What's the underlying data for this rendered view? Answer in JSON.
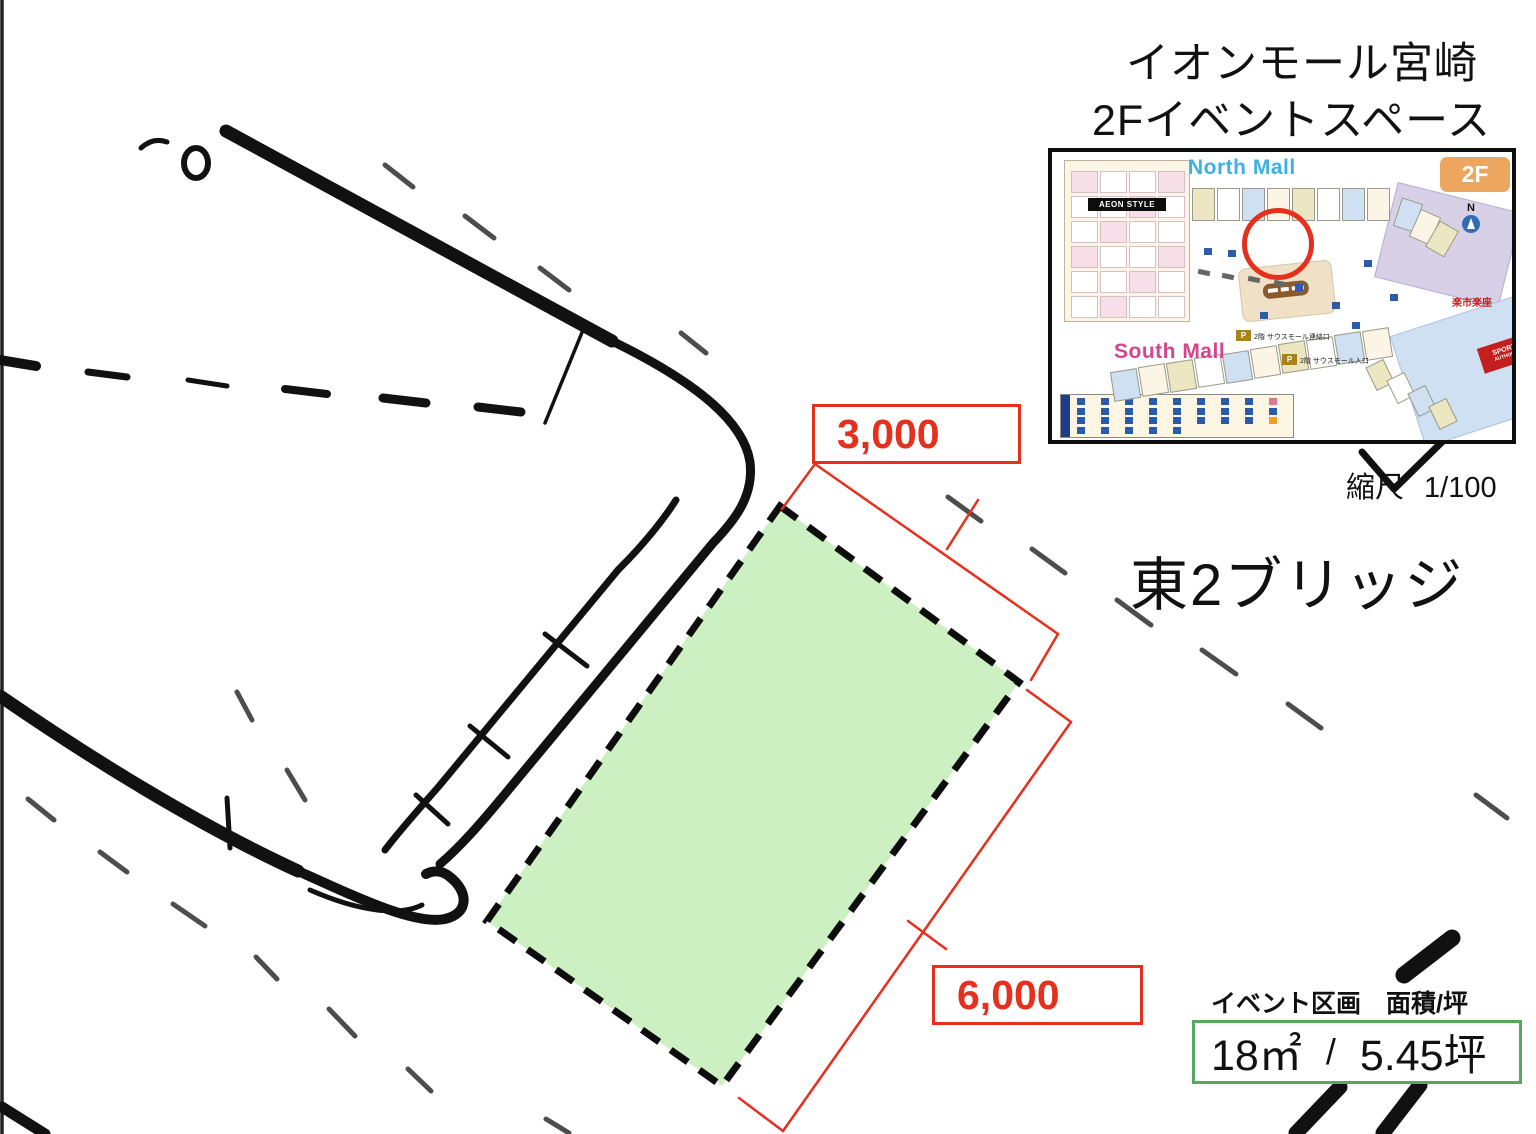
{
  "header": {
    "title_line1": "イオンモール宮崎",
    "title_line2": "2Fイベントスペース"
  },
  "scale": {
    "label": "縮尺",
    "value": "1/100"
  },
  "location_title": "東2ブリッジ",
  "dimensions": {
    "top": "3,000",
    "side": "6,000"
  },
  "area_panel": {
    "label": "イベント区画　面積/坪",
    "m2": "18㎡",
    "separator": "/",
    "tsubo": "5.45坪"
  },
  "map_inset": {
    "floor_badge": "2F",
    "north_mall": "North Mall",
    "south_mall": "South Mall",
    "store_banner": "AEON STYLE",
    "sports_line1": "SPORTS",
    "sports_line2": "AUTHORITY",
    "restaurant": "楽市楽座",
    "parking_badge": "P",
    "entrance1": "2階 サウスモール連絡口",
    "entrance2": "2階 サウスモール入口",
    "compass": "N"
  },
  "colors": {
    "accent_red": "#e5301d",
    "space_fill": "#cdf0c3",
    "area_box_border": "#57a85c",
    "north_mall_blue": "#3fb0e4",
    "south_mall_pink": "#d5448c",
    "badge_orange": "#eca660"
  }
}
